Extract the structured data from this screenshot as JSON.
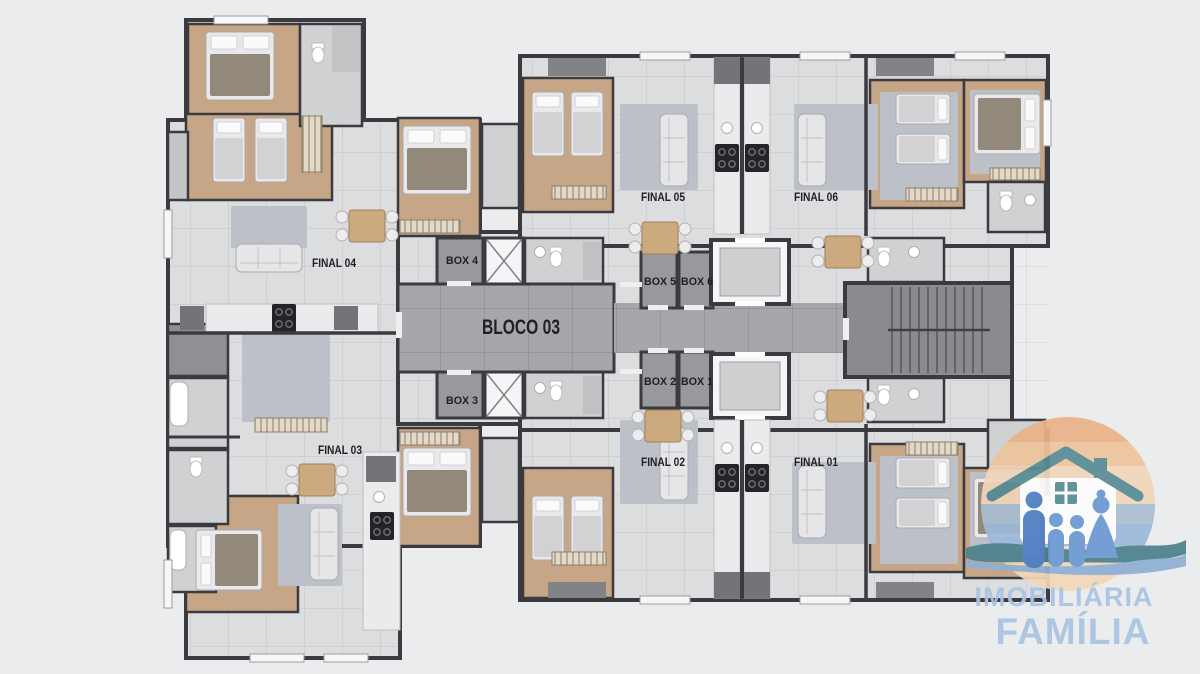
{
  "plan": {
    "labels": {
      "bloco": "BLOCO 03",
      "final_01": "FINAL 01",
      "final_02": "FINAL 02",
      "final_03": "FINAL 03",
      "final_04": "FINAL 04",
      "final_05": "FINAL 05",
      "final_06": "FINAL 06",
      "box_1": "BOX 1",
      "box_2": "BOX 2",
      "box_3": "BOX 3",
      "box_4": "BOX 4",
      "box_5": "BOX 5",
      "box_6": "BOX 6"
    }
  },
  "logo": {
    "line1": "IMOBILIÁRIA",
    "line2": "FAMÍLIA",
    "icon": "house-family-icon"
  },
  "palette": {
    "background": "#ebecee",
    "walls": "#3b3b3f",
    "floor_light": "#dcdddf",
    "floor_wood": "#c6a687",
    "hall_gray": "#a6a7aa",
    "box_gray": "#98999c",
    "stair_concrete": "#8a8b8e",
    "label_text": "#1f1f24",
    "logo_text_blue": "#a9c4e2",
    "logo_roof_teal": "#588d95",
    "logo_family_blue": "#4e7fc4",
    "logo_peach": "#ecbd97"
  }
}
